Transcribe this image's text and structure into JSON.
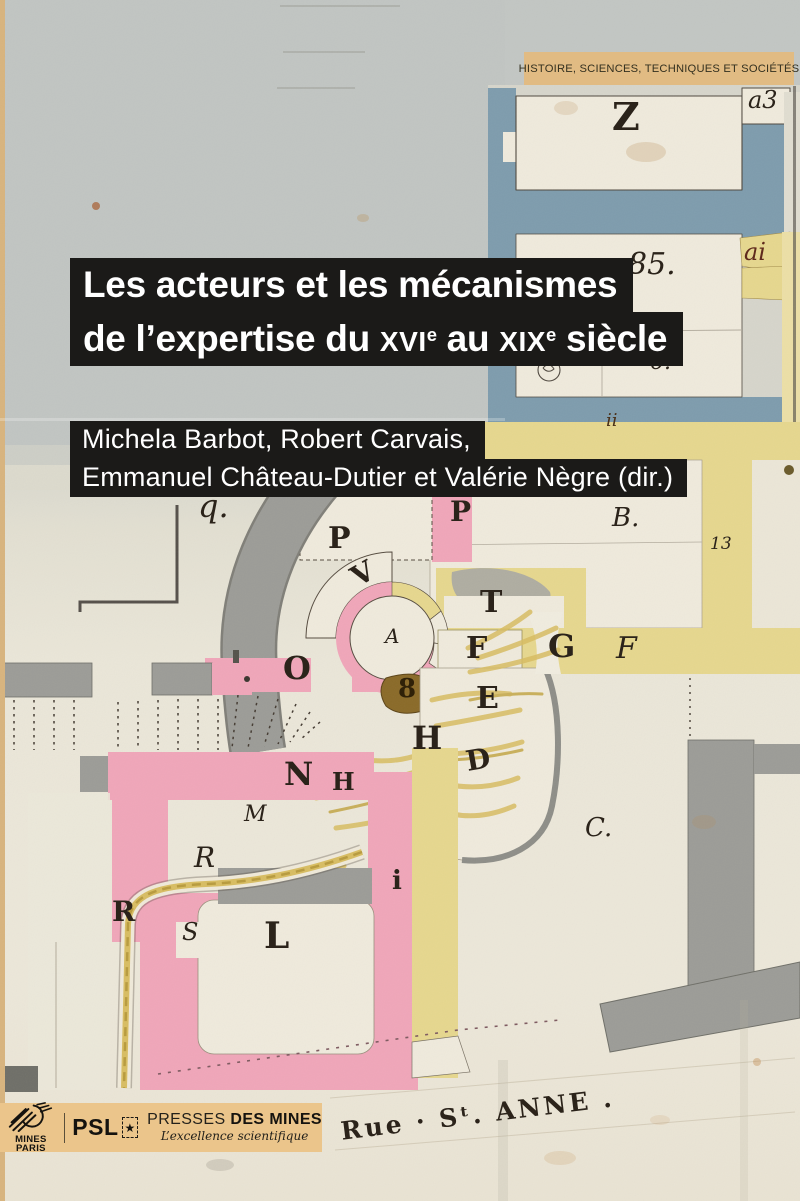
{
  "cover": {
    "series_banner": "HISTOIRE, SCIENCES, TECHNIQUES ET SOCIÉTÉS",
    "title_line1": "Les acteurs et les mécanismes",
    "title_line2": {
      "pre": "de l’expertise du ",
      "c1": "XVI",
      "s1": "e",
      "mid": " au ",
      "c2": "XIX",
      "s2": "e",
      "post": " siècle"
    },
    "authors_line1": "Michela Barbot, Robert Carvais,",
    "authors_line2": "Emmanuel Château-Dutier et Valérie Nègre (dir.)"
  },
  "publisher": {
    "mines": "MINES PARIS",
    "psl": "PSL",
    "star": "★",
    "presses_light": "PRESSES",
    "presses_bold": "DES MINES",
    "tagline": "L’excellence scientifique"
  },
  "colors": {
    "gold": "#e1bb83",
    "gold2": "#ebc58b",
    "bar": "#1b1a18",
    "blue": "#7e9cad",
    "pink": "#f0a6b9",
    "yellow": "#e6d78e",
    "yellowPale": "#ecdfa6",
    "straw": "#d8bd62",
    "gray": "#9c9c97",
    "grayDark": "#807f78",
    "ink": "#453c33",
    "letter": "#2b231a",
    "room": "#efeadc",
    "paperTop": "#c3c7c4",
    "paperBot": "#ece7d9",
    "maroon": "#5f2a1d",
    "olive": "#8a6a28"
  },
  "map": {
    "labels": [
      {
        "t": "Z",
        "x": 612,
        "y": 98,
        "fs": 38
      },
      {
        "t": "a3",
        "x": 748,
        "y": 88,
        "fs": 24,
        "it": true
      },
      {
        "t": "85.",
        "x": 628,
        "y": 250,
        "fs": 30,
        "it": true
      },
      {
        "t": "ai",
        "x": 744,
        "y": 240,
        "fs": 24,
        "it": true,
        "col": "#5f2a1d"
      },
      {
        "t": "6.",
        "x": 650,
        "y": 352,
        "fs": 22,
        "it": true
      },
      {
        "t": "ii",
        "x": 606,
        "y": 412,
        "fs": 18,
        "it": true,
        "col": "#4a3018"
      },
      {
        "t": "B.",
        "x": 612,
        "y": 505,
        "fs": 26,
        "it": true
      },
      {
        "t": "13",
        "x": 710,
        "y": 536,
        "fs": 17,
        "it": true
      },
      {
        "t": "q.",
        "x": 198,
        "y": 490,
        "fs": 32,
        "it": true
      },
      {
        "t": "P",
        "x": 328,
        "y": 524,
        "fs": 30
      },
      {
        "t": "P",
        "x": 450,
        "y": 498,
        "fs": 28
      },
      {
        "t": "V",
        "x": 352,
        "y": 560,
        "fs": 28,
        "rot": -30
      },
      {
        "t": "A",
        "x": 385,
        "y": 626,
        "fs": 20,
        "it": true
      },
      {
        "t": "O",
        "x": 283,
        "y": 652,
        "fs": 32
      },
      {
        "t": "8",
        "x": 398,
        "y": 676,
        "fs": 26,
        "col": "#2f2108"
      },
      {
        "t": "T",
        "x": 480,
        "y": 588,
        "fs": 30
      },
      {
        "t": "F",
        "x": 466,
        "y": 634,
        "fs": 30
      },
      {
        "t": "G",
        "x": 548,
        "y": 630,
        "fs": 32
      },
      {
        "t": "F",
        "x": 616,
        "y": 634,
        "fs": 30,
        "it": true
      },
      {
        "t": "E",
        "x": 476,
        "y": 684,
        "fs": 30
      },
      {
        "t": "H",
        "x": 412,
        "y": 722,
        "fs": 32
      },
      {
        "t": "D",
        "x": 466,
        "y": 746,
        "fs": 28,
        "rot": -10
      },
      {
        "t": "N",
        "x": 284,
        "y": 758,
        "fs": 32
      },
      {
        "t": "H",
        "x": 332,
        "y": 770,
        "fs": 24
      },
      {
        "t": "M",
        "x": 244,
        "y": 804,
        "fs": 22,
        "it": true
      },
      {
        "t": "R",
        "x": 194,
        "y": 844,
        "fs": 28,
        "it": true
      },
      {
        "t": "R",
        "x": 112,
        "y": 898,
        "fs": 28
      },
      {
        "t": "i",
        "x": 392,
        "y": 868,
        "fs": 26
      },
      {
        "t": "S",
        "x": 182,
        "y": 920,
        "fs": 24,
        "it": true
      },
      {
        "t": "L",
        "x": 264,
        "y": 918,
        "fs": 36
      },
      {
        "t": "C.",
        "x": 585,
        "y": 815,
        "fs": 26,
        "it": true
      },
      {
        "t": "Rue · Sᵗ. ANNE .",
        "x": 340,
        "y": 1102,
        "fs": 25,
        "rot": -7,
        "ls": 3,
        "name": "street-label"
      }
    ]
  }
}
